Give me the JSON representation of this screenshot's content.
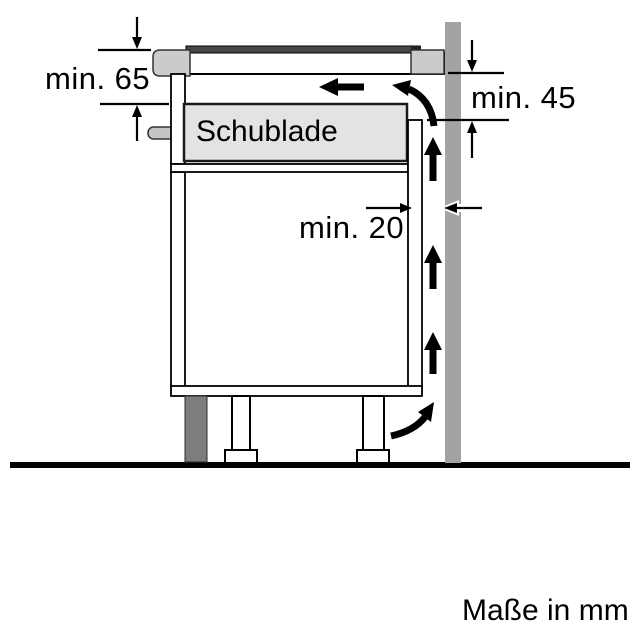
{
  "diagram": {
    "drawer_label": "Schublade",
    "dimensions": {
      "top_front": "min. 65",
      "side_wall": "min. 45",
      "back_gap": "min. 20"
    },
    "units_note": "Maße in mm"
  },
  "colors": {
    "background": "#ffffff",
    "outline": "#000000",
    "wall": "#a3a3a3",
    "plinth": "#7d7d7d",
    "hob_trim": "#cbcbcb",
    "hob_glass": "#484848",
    "drawer_fill": "#e3e3e3",
    "handle": "#c4c4c4",
    "arrow": "#000000"
  }
}
